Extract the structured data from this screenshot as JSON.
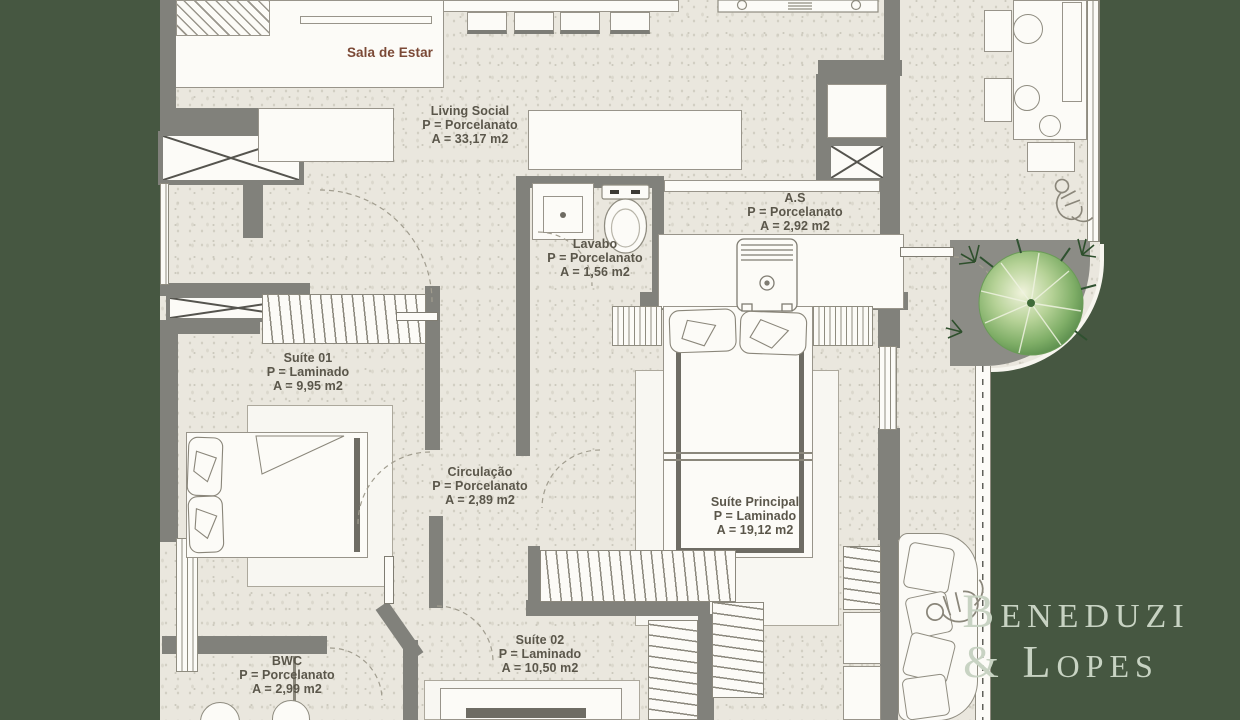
{
  "colors": {
    "background_green": "#465741",
    "paper": "#eae7de",
    "wall_gray": "#81817b",
    "label_text": "#5a564a",
    "sala_label_text": "#7b4936",
    "logo_text": "#c8d3c3"
  },
  "rooms": [
    {
      "name": "Sala de Estar",
      "flooring": "",
      "area": ""
    },
    {
      "name": "Living Social",
      "flooring": "P = Porcelanato",
      "area": "A = 33,17 m2"
    },
    {
      "name": "Lavabo",
      "flooring": "P = Porcelanato",
      "area": "A = 1,56 m2"
    },
    {
      "name": "A.S",
      "flooring": "P = Porcelanato",
      "area": "A = 2,92 m2"
    },
    {
      "name": "Suíte 01",
      "flooring": "P = Laminado",
      "area": "A = 9,95 m2"
    },
    {
      "name": "Circulação",
      "flooring": "P = Porcelanato",
      "area": "A = 2,89 m2"
    },
    {
      "name": "Suíte Principal",
      "flooring": "P = Laminado",
      "area": "A = 19,12 m2"
    },
    {
      "name": "Suíte 02",
      "flooring": "P = Laminado",
      "area": "A = 10,50 m2"
    },
    {
      "name": "BWC",
      "flooring": "P = Porcelanato",
      "area": "A = 2,99 m2"
    }
  ],
  "logo": {
    "line1": "Beneduzi",
    "line2": "& Lopes"
  }
}
